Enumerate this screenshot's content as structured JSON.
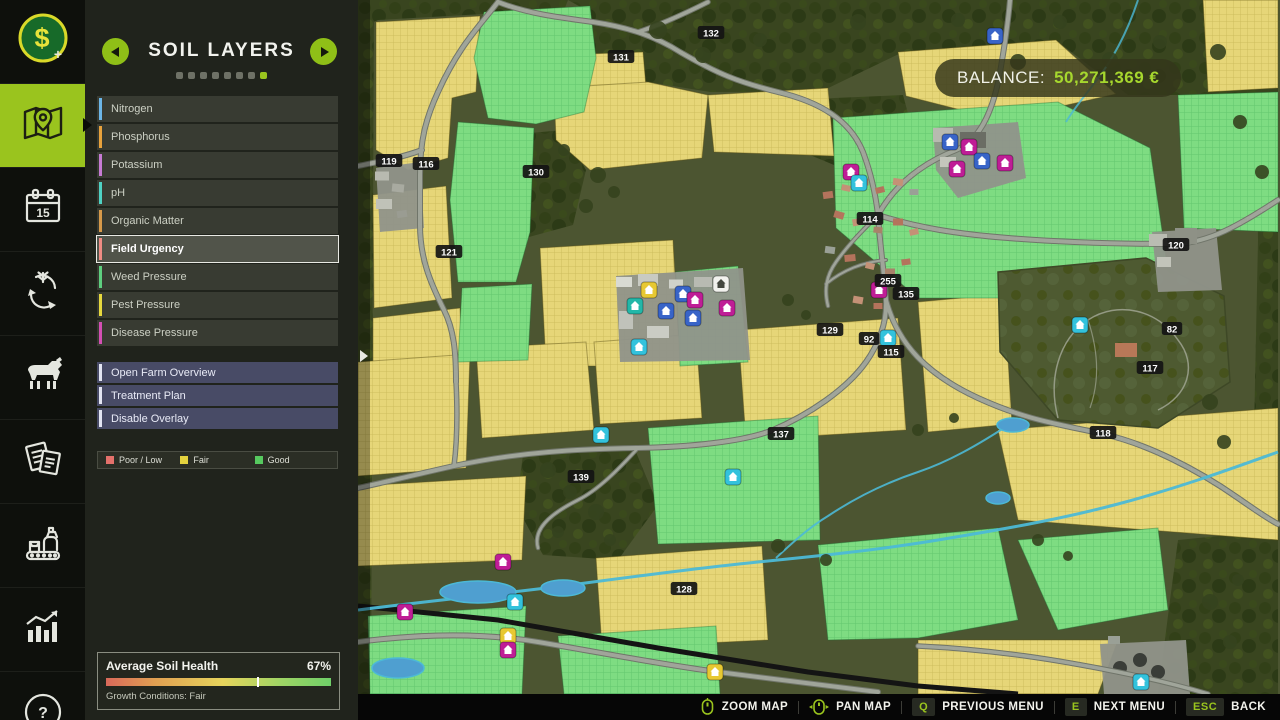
{
  "accent_color": "#9ac41e",
  "sidebar": {
    "items": [
      {
        "name": "finances",
        "icon": "money-icon",
        "selected": false
      },
      {
        "name": "map",
        "icon": "map-icon",
        "selected": true
      },
      {
        "name": "calendar",
        "icon": "calendar-icon",
        "selected": false
      },
      {
        "name": "crop-rotation",
        "icon": "rotation-icon",
        "selected": false
      },
      {
        "name": "animals",
        "icon": "animals-icon",
        "selected": false
      },
      {
        "name": "contracts",
        "icon": "contracts-icon",
        "selected": false
      },
      {
        "name": "production",
        "icon": "production-icon",
        "selected": false
      },
      {
        "name": "statistics",
        "icon": "statistics-icon",
        "selected": false
      },
      {
        "name": "help",
        "icon": "help-icon",
        "selected": false
      }
    ]
  },
  "panel": {
    "title": "SOIL LAYERS",
    "pagination": {
      "total": 8,
      "active_index": 7
    },
    "layers": [
      {
        "label": "Nitrogen",
        "color": "#6cb6e8",
        "selected": false
      },
      {
        "label": "Phosphorus",
        "color": "#e8a23c",
        "selected": false
      },
      {
        "label": "Potassium",
        "color": "#c77bd4",
        "selected": false
      },
      {
        "label": "pH",
        "color": "#4fd2c4",
        "selected": false
      },
      {
        "label": "Organic Matter",
        "color": "#d79a4a",
        "selected": false
      },
      {
        "label": "Field Urgency",
        "color": "#ef8c84",
        "selected": true
      },
      {
        "label": "Weed Pressure",
        "color": "#5ecf7f",
        "selected": false
      },
      {
        "label": "Pest Pressure",
        "color": "#e6d83e",
        "selected": false
      },
      {
        "label": "Disease Pressure",
        "color": "#d44fb4",
        "selected": false
      }
    ],
    "actions": [
      {
        "label": "Open Farm Overview"
      },
      {
        "label": "Treatment Plan"
      },
      {
        "label": "Disable Overlay"
      }
    ],
    "legend": [
      {
        "label": "Poor / Low",
        "color": "#e4716b"
      },
      {
        "label": "Fair",
        "color": "#e4d23e"
      },
      {
        "label": "Good",
        "color": "#56c95f"
      }
    ],
    "soil_health": {
      "title": "Average Soil Health",
      "value": "67%",
      "percent": 67,
      "subtitle": "Growth Conditions: Fair"
    }
  },
  "balance": {
    "label": "BALANCE:",
    "value": "50,271,369 €"
  },
  "bottom_bar": {
    "items": [
      {
        "icon": "mouse-zoom-icon",
        "key": "",
        "label": "ZOOM MAP"
      },
      {
        "icon": "mouse-pan-icon",
        "key": "",
        "label": "PAN MAP"
      },
      {
        "icon": "",
        "key": "Q",
        "label": "PREVIOUS MENU"
      },
      {
        "icon": "",
        "key": "E",
        "label": "NEXT MENU"
      },
      {
        "icon": "",
        "key": "ESC",
        "label": "BACK"
      }
    ]
  },
  "map": {
    "palette": {
      "terrain": "#4c5531",
      "forest": "#39451f",
      "fair": "#e6d678",
      "good": "#7edc82",
      "road": "#a0a59a",
      "road_casing": "#70756a",
      "rail": "#141414",
      "water": "#4cb9d6",
      "badge_bg": "#141414",
      "badge_text": "#ffffff"
    },
    "marker_colors": {
      "blue": "#3864c8",
      "magenta": "#bf1d96",
      "cyan": "#33c2dc",
      "yellow": "#e7c832",
      "teal": "#23b7a8",
      "white": "#f2f2ee"
    },
    "field_labels": [
      {
        "label": "132",
        "x": 353,
        "y": 33
      },
      {
        "label": "131",
        "x": 263,
        "y": 57
      },
      {
        "label": "119",
        "x": 31,
        "y": 161
      },
      {
        "label": "116",
        "x": 68,
        "y": 164
      },
      {
        "label": "130",
        "x": 178,
        "y": 172
      },
      {
        "label": "121",
        "x": 91,
        "y": 252
      },
      {
        "label": "114",
        "x": 512,
        "y": 219
      },
      {
        "label": "255",
        "x": 530,
        "y": 281
      },
      {
        "label": "135",
        "x": 548,
        "y": 294
      },
      {
        "label": "129",
        "x": 472,
        "y": 330
      },
      {
        "label": "92",
        "x": 511,
        "y": 339
      },
      {
        "label": "115",
        "x": 533,
        "y": 352
      },
      {
        "label": "120",
        "x": 818,
        "y": 245
      },
      {
        "label": "82",
        "x": 814,
        "y": 329
      },
      {
        "label": "117",
        "x": 792,
        "y": 368
      },
      {
        "label": "118",
        "x": 745,
        "y": 433
      },
      {
        "label": "137",
        "x": 423,
        "y": 434
      },
      {
        "label": "139",
        "x": 223,
        "y": 477
      },
      {
        "label": "128",
        "x": 326,
        "y": 589
      }
    ],
    "markers": [
      {
        "c": "blue",
        "x": 637,
        "y": 36
      },
      {
        "c": "blue",
        "x": 592,
        "y": 142
      },
      {
        "c": "magenta",
        "x": 611,
        "y": 147
      },
      {
        "c": "blue",
        "x": 624,
        "y": 161
      },
      {
        "c": "magenta",
        "x": 599,
        "y": 169
      },
      {
        "c": "magenta",
        "x": 647,
        "y": 163
      },
      {
        "c": "magenta",
        "x": 493,
        "y": 172
      },
      {
        "c": "cyan",
        "x": 501,
        "y": 183
      },
      {
        "c": "magenta",
        "x": 521,
        "y": 290
      },
      {
        "c": "cyan",
        "x": 530,
        "y": 338
      },
      {
        "c": "yellow",
        "x": 291,
        "y": 290
      },
      {
        "c": "white",
        "x": 363,
        "y": 284
      },
      {
        "c": "blue",
        "x": 325,
        "y": 294
      },
      {
        "c": "blue",
        "x": 308,
        "y": 311
      },
      {
        "c": "blue",
        "x": 335,
        "y": 318
      },
      {
        "c": "magenta",
        "x": 337,
        "y": 300
      },
      {
        "c": "magenta",
        "x": 369,
        "y": 308
      },
      {
        "c": "teal",
        "x": 277,
        "y": 306
      },
      {
        "c": "cyan",
        "x": 281,
        "y": 347
      },
      {
        "c": "cyan",
        "x": 243,
        "y": 435
      },
      {
        "c": "cyan",
        "x": 375,
        "y": 477
      },
      {
        "c": "cyan",
        "x": 722,
        "y": 325
      },
      {
        "c": "magenta",
        "x": 145,
        "y": 562
      },
      {
        "c": "cyan",
        "x": 157,
        "y": 602
      },
      {
        "c": "yellow",
        "x": 150,
        "y": 636
      },
      {
        "c": "magenta",
        "x": 150,
        "y": 650
      },
      {
        "c": "magenta",
        "x": 47,
        "y": 612
      },
      {
        "c": "yellow",
        "x": 357,
        "y": 672
      },
      {
        "c": "cyan",
        "x": 783,
        "y": 682
      }
    ]
  }
}
